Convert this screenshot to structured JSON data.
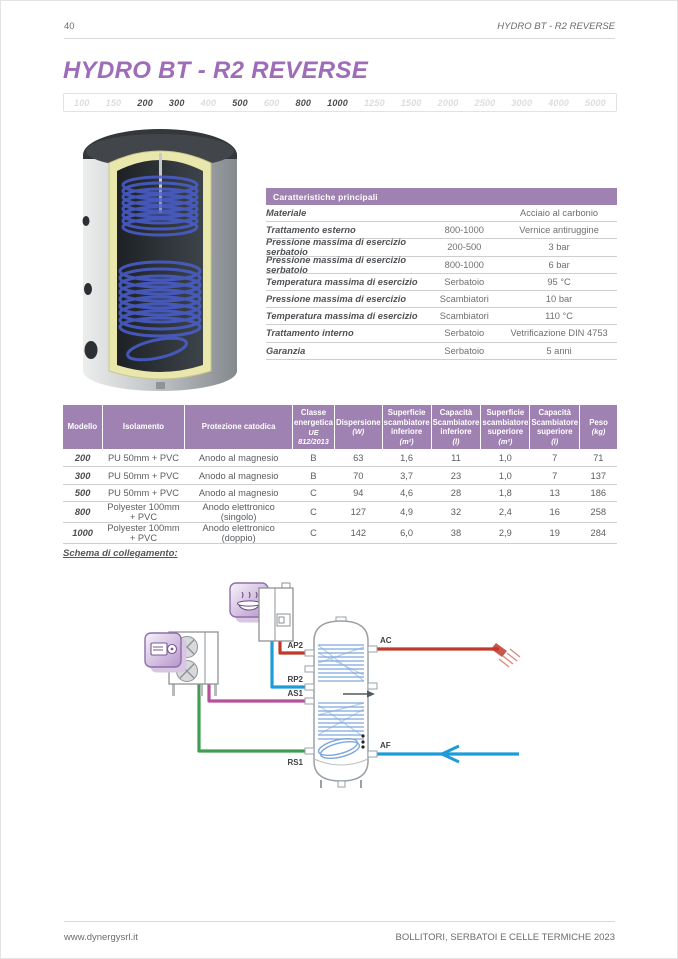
{
  "page": {
    "number": "40",
    "header_right": "HYDRO BT - R2 REVERSE",
    "title": "HYDRO BT - R2 REVERSE",
    "footer_left": "www.dynergysrl.it",
    "footer_right": "BOLLITORI, SERBATOI E CELLE TERMICHE 2023"
  },
  "capacity_strip": {
    "items": [
      {
        "label": "100",
        "active": false
      },
      {
        "label": "150",
        "active": false
      },
      {
        "label": "200",
        "active": true
      },
      {
        "label": "300",
        "active": true
      },
      {
        "label": "400",
        "active": false
      },
      {
        "label": "500",
        "active": true
      },
      {
        "label": "600",
        "active": false
      },
      {
        "label": "800",
        "active": true
      },
      {
        "label": "1000",
        "active": true
      },
      {
        "label": "1250",
        "active": false
      },
      {
        "label": "1500",
        "active": false
      },
      {
        "label": "2000",
        "active": false
      },
      {
        "label": "2500",
        "active": false
      },
      {
        "label": "3000",
        "active": false
      },
      {
        "label": "4000",
        "active": false
      },
      {
        "label": "5000",
        "active": false
      }
    ]
  },
  "characteristics": {
    "header": "Caratteristiche principali",
    "rows": [
      {
        "label": "Materiale",
        "col2": "",
        "col3": "Acciaio al carbonio"
      },
      {
        "label": "Trattamento esterno",
        "col2": "800-1000",
        "col3": "Vernice antiruggine"
      },
      {
        "label": "Pressione massima di esercizio serbatoio",
        "col2": "200-500",
        "col3": "3 bar"
      },
      {
        "label": "Pressione massima di esercizio serbatoio",
        "col2": "800-1000",
        "col3": "6 bar"
      },
      {
        "label": "Temperatura massima di esercizio",
        "col2": "Serbatoio",
        "col3": "95 °C"
      },
      {
        "label": "Pressione massima di esercizio",
        "col2": "Scambiatori",
        "col3": "10 bar"
      },
      {
        "label": "Temperatura massima di esercizio",
        "col2": "Scambiatori",
        "col3": "110 °C"
      },
      {
        "label": "Trattamento interno",
        "col2": "Serbatoio",
        "col3": "Vetrificazione DIN 4753"
      },
      {
        "label": "Garanzia",
        "col2": "Serbatoio",
        "col3": "5 anni"
      }
    ]
  },
  "models_table": {
    "headers": [
      {
        "label": "Modello",
        "unit": ""
      },
      {
        "label": "Isolamento",
        "unit": ""
      },
      {
        "label": "Protezione catodica",
        "unit": ""
      },
      {
        "label": "Classe energetica",
        "unit": "UE 812/2013"
      },
      {
        "label": "Dispersione",
        "unit": "(W)"
      },
      {
        "label": "Superficie scambiatore inferiore",
        "unit": "(m²)"
      },
      {
        "label": "Capacità Scambiatore inferiore",
        "unit": "(l)"
      },
      {
        "label": "Superficie scambiatore superiore",
        "unit": "(m²)"
      },
      {
        "label": "Capacità Scambiatore superiore",
        "unit": "(l)"
      },
      {
        "label": "Peso",
        "unit": "(kg)"
      }
    ],
    "rows": [
      [
        "200",
        "PU 50mm + PVC",
        "Anodo al magnesio",
        "B",
        "63",
        "1,6",
        "11",
        "1,0",
        "7",
        "71"
      ],
      [
        "300",
        "PU 50mm + PVC",
        "Anodo al magnesio",
        "B",
        "70",
        "3,7",
        "23",
        "1,0",
        "7",
        "137"
      ],
      [
        "500",
        "PU 50mm + PVC",
        "Anodo al magnesio",
        "C",
        "94",
        "4,6",
        "28",
        "1,8",
        "13",
        "186"
      ],
      [
        "800",
        "Polyester 100mm + PVC",
        "Anodo elettronico (singolo)",
        "C",
        "127",
        "4,9",
        "32",
        "2,4",
        "16",
        "258"
      ],
      [
        "1000",
        "Polyester 100mm + PVC",
        "Anodo elettronico (doppio)",
        "C",
        "142",
        "6,0",
        "38",
        "2,9",
        "19",
        "284"
      ]
    ]
  },
  "schema": {
    "caption": "Schema di collegamento:",
    "labels": {
      "ap2": "AP2",
      "rp2": "RP2",
      "as1": "AS1",
      "rs1": "RS1",
      "ac": "AC",
      "af": "AF"
    }
  },
  "colors": {
    "accent_purple": "#9E6CB9",
    "table_header_purple": "#9F82B1",
    "pipe_red": "#C0392B",
    "pipe_blue": "#1D9CD8",
    "pipe_green": "#3E9E52",
    "pipe_magenta": "#B4509E"
  }
}
